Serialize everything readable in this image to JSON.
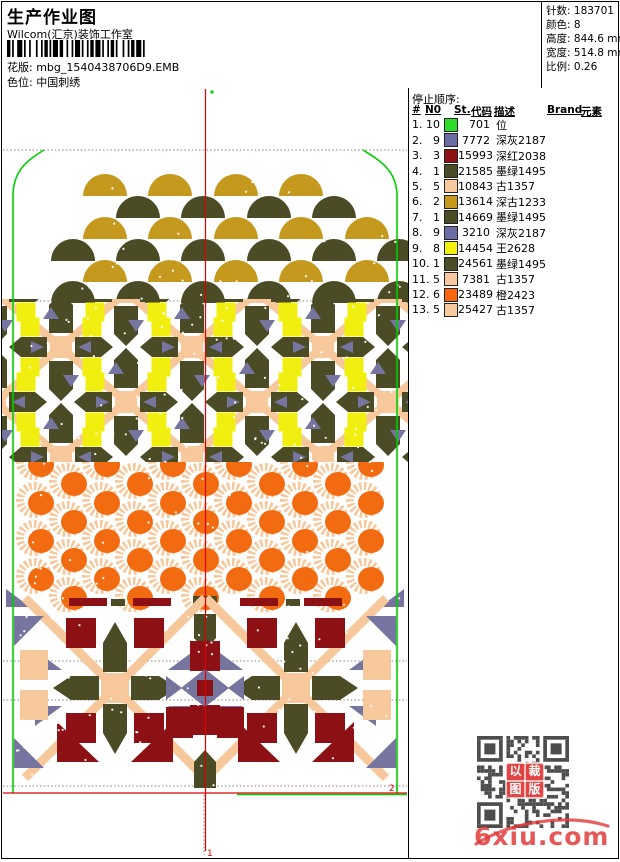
{
  "header": {
    "title": "生产作业图",
    "studio": "Wilcom(汇京)装饰工作室",
    "pattern": {
      "label": "花版:",
      "value": "mbg_1540438706D9.EMB"
    },
    "colorway": {
      "label": "色位:",
      "value": "中国刺绣"
    },
    "stats": [
      {
        "label": "针数:",
        "value": "183701"
      },
      {
        "label": "颜色:",
        "value": "8"
      },
      {
        "label": "高度:",
        "value": "844.6 mm"
      },
      {
        "label": "宽度:",
        "value": "514.8 mm"
      },
      {
        "label": "比例:",
        "value": "0.26"
      }
    ]
  },
  "stop_sequence": {
    "title": "停止顺序:",
    "columns": {
      "idx": "#",
      "needle": "N0",
      "stitches": "St.",
      "code": "代码",
      "desc": "描述",
      "brand": "Brand",
      "element": "元素"
    },
    "rows": [
      {
        "idx": "1.",
        "needle": "10",
        "color": "#2cdd2c",
        "stitches": "701",
        "code": "",
        "desc": "位",
        "brand": "",
        "element": ""
      },
      {
        "idx": "2.",
        "needle": "9",
        "color": "#6b6ba5",
        "stitches": "7772",
        "code": "",
        "desc": "深灰2187",
        "brand": "",
        "element": ""
      },
      {
        "idx": "3.",
        "needle": "3",
        "color": "#8c1014",
        "stitches": "15993",
        "code": "",
        "desc": "深红2038",
        "brand": "",
        "element": ""
      },
      {
        "idx": "4.",
        "needle": "1",
        "color": "#4b4b25",
        "stitches": "21585",
        "code": "",
        "desc": "墨绿1495",
        "brand": "",
        "element": ""
      },
      {
        "idx": "5.",
        "needle": "5",
        "color": "#f8c99e",
        "stitches": "10843",
        "code": "",
        "desc": "古1357",
        "brand": "",
        "element": ""
      },
      {
        "idx": "6.",
        "needle": "2",
        "color": "#c6981c",
        "stitches": "13614",
        "code": "",
        "desc": "深古1233",
        "brand": "",
        "element": ""
      },
      {
        "idx": "7.",
        "needle": "1",
        "color": "#4b4b25",
        "stitches": "14669",
        "code": "",
        "desc": "墨绿1495",
        "brand": "",
        "element": ""
      },
      {
        "idx": "8.",
        "needle": "9",
        "color": "#6b6ba5",
        "stitches": "3210",
        "code": "",
        "desc": "深灰2187",
        "brand": "",
        "element": ""
      },
      {
        "idx": "9.",
        "needle": "8",
        "color": "#f2f20c",
        "stitches": "14454",
        "code": "",
        "desc": "王2628",
        "brand": "",
        "element": ""
      },
      {
        "idx": "10.",
        "needle": "1",
        "color": "#4b4b25",
        "stitches": "24561",
        "code": "",
        "desc": "墨绿1495",
        "brand": "",
        "element": ""
      },
      {
        "idx": "11.",
        "needle": "5",
        "color": "#f8c99e",
        "stitches": "7381",
        "code": "",
        "desc": "古1357",
        "brand": "",
        "element": ""
      },
      {
        "idx": "12.",
        "needle": "6",
        "color": "#f8670e",
        "stitches": "23489",
        "code": "",
        "desc": "橙2423",
        "brand": "",
        "element": ""
      },
      {
        "idx": "13.",
        "needle": "5",
        "color": "#f8c99e",
        "stitches": "25427",
        "code": "",
        "desc": "古1357",
        "brand": "",
        "element": ""
      }
    ]
  },
  "design": {
    "palette": {
      "gold": "#c5991d",
      "olive": "#4b4b25",
      "yellow": "#f0ef10",
      "peach": "#f6c89c",
      "slate": "#75759f",
      "orange": "#f26b10",
      "darkred": "#8c1014",
      "green": "#00cf00",
      "red": "#e00000",
      "grid": "#808080",
      "qr": "#4d4d4d"
    },
    "section_marks": {
      "bottom_center": "1",
      "bottom_right": "2"
    }
  },
  "qr_stamp": {
    "chars": [
      "以",
      "裁",
      "图",
      "版"
    ]
  },
  "watermark": {
    "text": "6xiu.com",
    "color": "#e23b3b"
  }
}
